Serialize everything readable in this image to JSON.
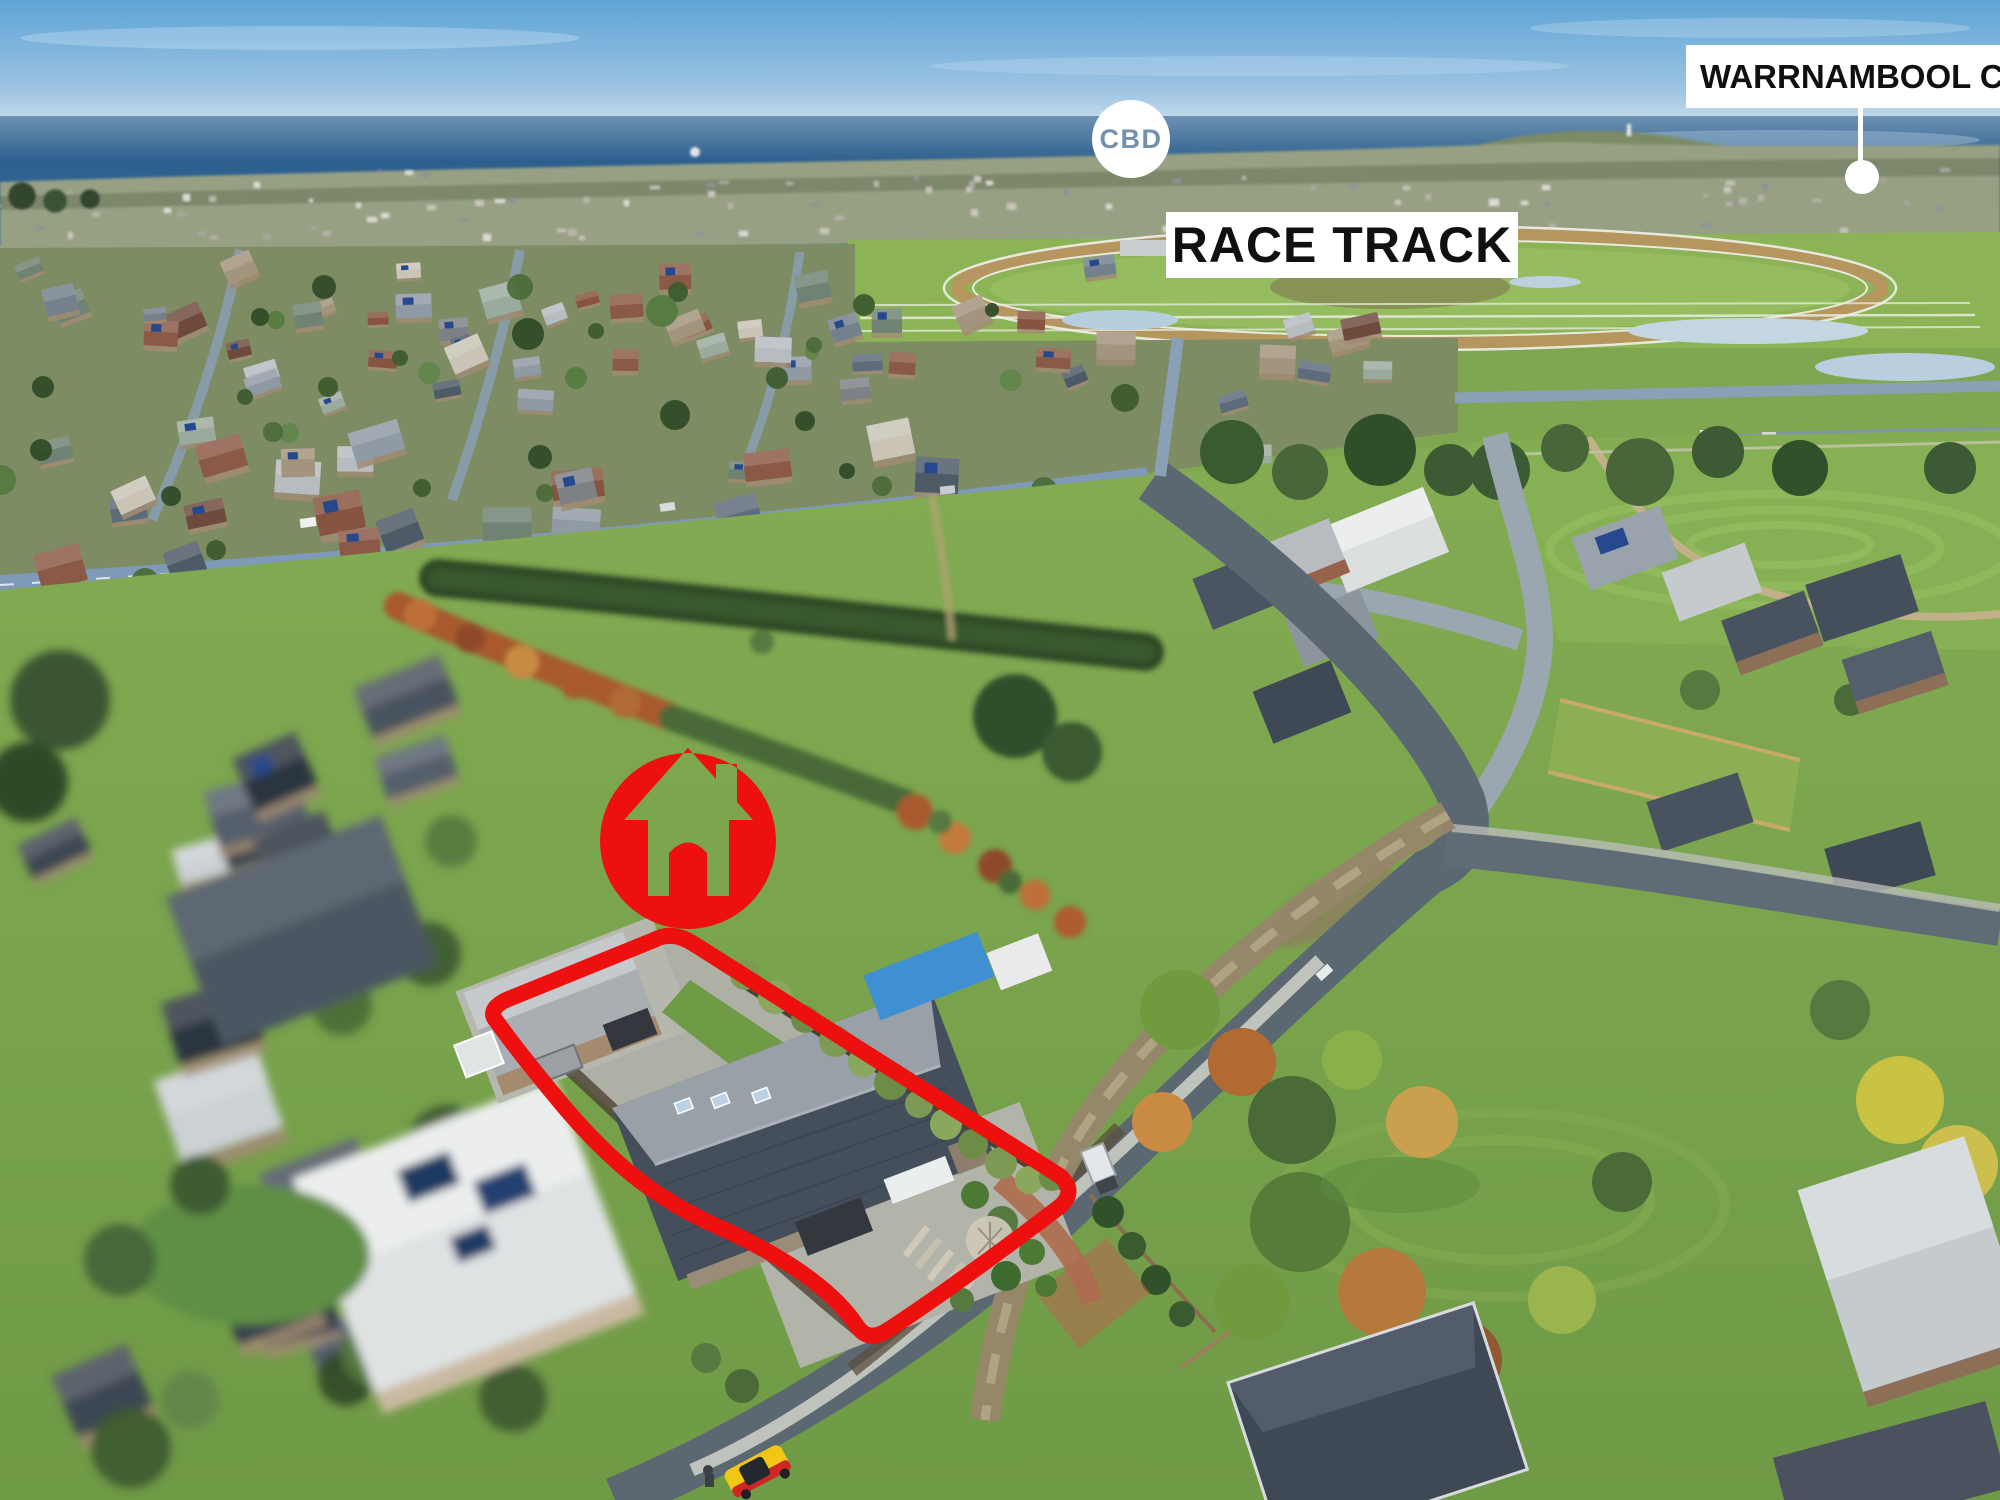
{
  "annotations": {
    "cbd_badge": {
      "label": "CBD",
      "background_color": "#ffffff",
      "text_color": "#7490ad"
    },
    "race_track_label": {
      "text": "RACE TRACK",
      "background_color": "#ffffff",
      "text_color": "#101010"
    },
    "college_label": {
      "text": "WARRNAMBOOL COLLEGE",
      "background_color": "#ffffff",
      "text_color": "#101010",
      "pointer": "white-line-and-dot"
    },
    "property_marker": {
      "icon": "house-icon",
      "color": "#ee0f0f"
    },
    "property_outline": {
      "color": "#ee0f0f",
      "shape": "rotated-rectangle-lot"
    }
  },
  "scene_colors": {
    "sky": "#68a9d8",
    "ocean": "#2e5f8c",
    "grass": "#7ea74f",
    "race_track_infield": "#95bc5e",
    "asphalt_road": "#5b6771",
    "subject_house_roof": "#454f5b",
    "marker_red": "#ee0f0f",
    "yellow_car": "#f2c614"
  }
}
